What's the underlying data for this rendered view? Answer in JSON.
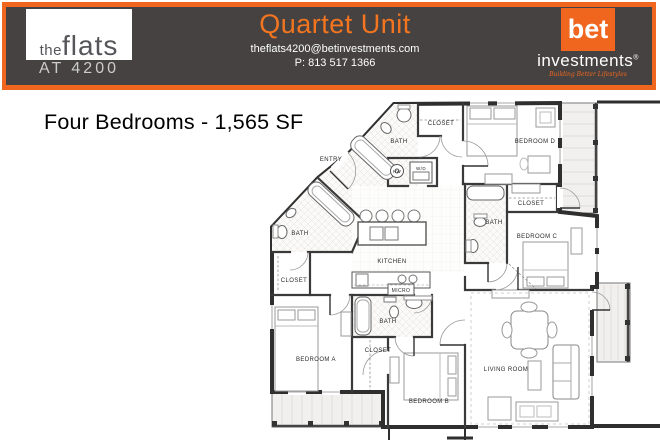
{
  "header": {
    "brand": {
      "line1_small": "the",
      "line1_large": "flats",
      "line2": "AT 4200"
    },
    "title": "Quartet Unit",
    "email": "theflats4200@betinvestments.com",
    "phone": "P: 813 517 1366",
    "bet": {
      "logo": "bet",
      "word": "investments",
      "reg": "®",
      "tagline": "Building Better Lifestyles"
    }
  },
  "headline": "Four Bedrooms - 1,565 SF",
  "colors": {
    "orange": "#f1661f",
    "title_orange": "#f4751f",
    "band_gray": "#454241",
    "wall": "#333333"
  },
  "floorplan": {
    "labels": [
      {
        "id": "entry",
        "text": "ENTRY"
      },
      {
        "id": "bath-top",
        "text": "BATH"
      },
      {
        "id": "closet-top",
        "text": "CLOSET"
      },
      {
        "id": "bedroom-d",
        "text": "BEDROOM D"
      },
      {
        "id": "hw",
        "text": "HW"
      },
      {
        "id": "wd",
        "text": "W/D"
      },
      {
        "id": "closet-c",
        "text": "CLOSET"
      },
      {
        "id": "bath-c",
        "text": "BATH"
      },
      {
        "id": "bedroom-c",
        "text": "BEDROOM C"
      },
      {
        "id": "kitchen",
        "text": "KITCHEN"
      },
      {
        "id": "bath-a",
        "text": "BATH"
      },
      {
        "id": "closet-a",
        "text": "CLOSET"
      },
      {
        "id": "micro",
        "text": "MICRO"
      },
      {
        "id": "bath-b",
        "text": "BATH"
      },
      {
        "id": "closet-b",
        "text": "CLOSET"
      },
      {
        "id": "bedroom-a",
        "text": "BEDROOM A"
      },
      {
        "id": "bedroom-b",
        "text": "BEDROOM B"
      },
      {
        "id": "living-room",
        "text": "LIVING ROOM"
      }
    ]
  }
}
